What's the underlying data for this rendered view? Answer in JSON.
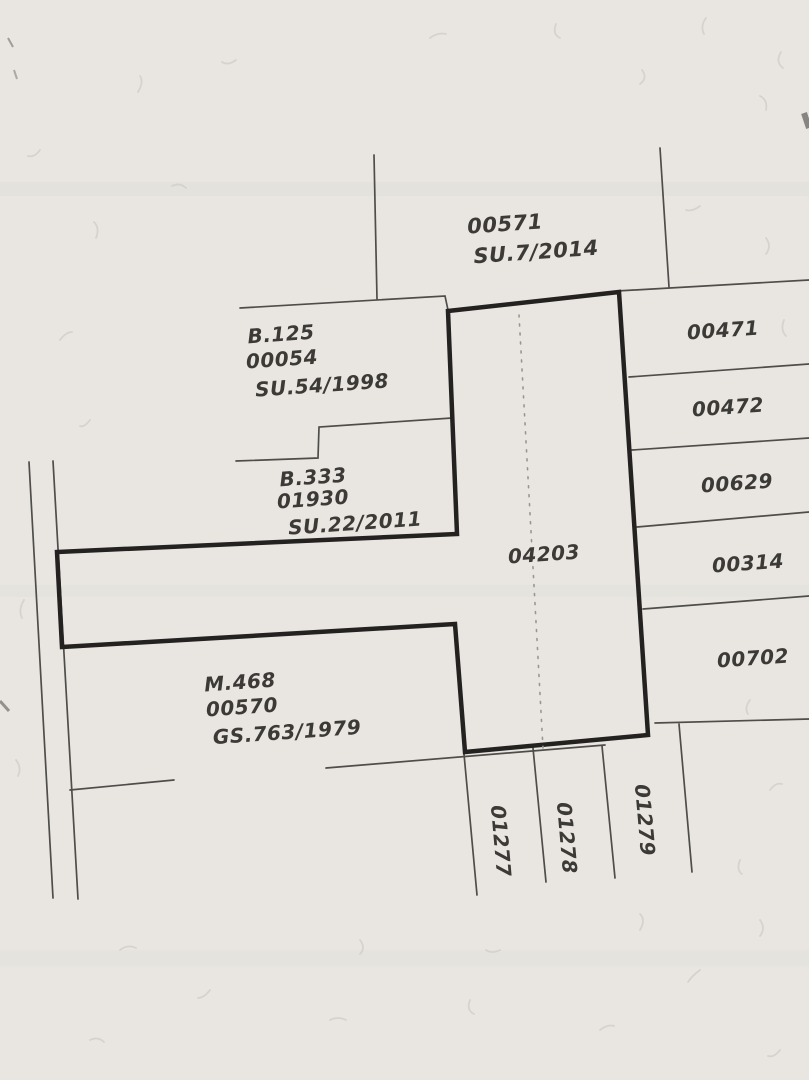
{
  "colors": {
    "paper": "#e9e6e2",
    "line_thin": "#4f4d4a",
    "line_bold": "#242220",
    "text": "#3c3a37",
    "dotted": "#9a968f"
  },
  "plan": {
    "north_parcel": {
      "number": "00571",
      "survey": "SU.7/2014"
    },
    "west_parcels": [
      {
        "name": "B.125",
        "number": "00054",
        "survey": "SU.54/1998"
      },
      {
        "name": "B.333",
        "number": "01930",
        "survey": "SU.22/2011"
      },
      {
        "name": "M.468",
        "number": "00570",
        "survey": "GS.763/1979"
      }
    ],
    "central_parcel": {
      "number": "04203"
    },
    "east_parcels": [
      {
        "number": "00471"
      },
      {
        "number": "00472"
      },
      {
        "number": "00629"
      },
      {
        "number": "00314"
      },
      {
        "number": "00702"
      }
    ],
    "south_parcels": [
      {
        "number": "01277"
      },
      {
        "number": "01278"
      },
      {
        "number": "01279"
      }
    ]
  }
}
